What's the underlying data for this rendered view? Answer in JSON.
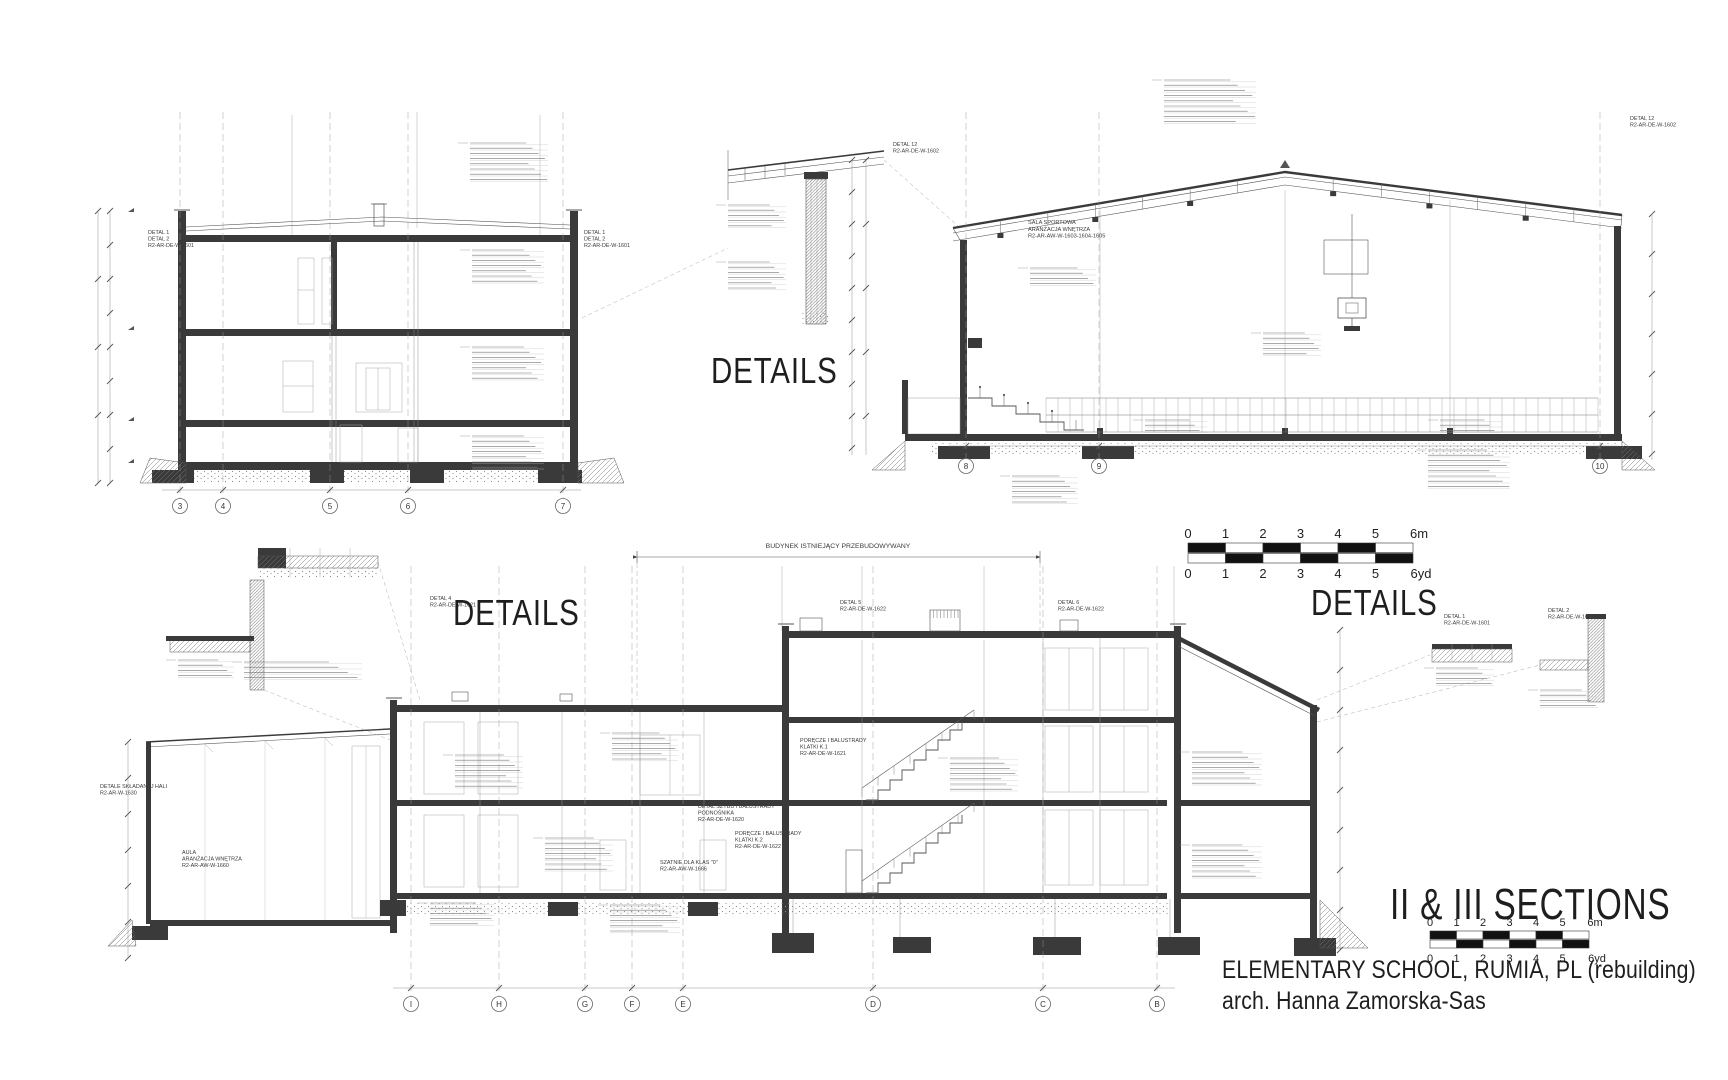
{
  "titles": {
    "details": "DETAILS",
    "sections": "II & III SECTIONS",
    "project": "ELEMENTARY SCHOOL, RUMIA, PL (rebuilding)",
    "architect": "arch. Hanna Zamorska-Sas"
  },
  "scalebar_units": {
    "m": [
      "0",
      "1",
      "2",
      "3",
      "4",
      "5",
      "6m"
    ],
    "yd": [
      "0",
      "1",
      "2",
      "3",
      "4",
      "5",
      "6yd"
    ]
  },
  "drawing": {
    "grids": [
      {
        "name": "upper-left-section",
        "top": 112,
        "dim_y": 490,
        "bubble_y": 506,
        "items": [
          {
            "label": "3",
            "x": 180
          },
          {
            "label": "4",
            "x": 223
          },
          {
            "label": "5",
            "x": 330
          },
          {
            "label": "6",
            "x": 408
          },
          {
            "label": "7",
            "x": 563
          }
        ]
      },
      {
        "name": "sports-hall",
        "top": 112,
        "dim_y": 446,
        "bubble_y": 466,
        "items": [
          {
            "label": "8",
            "x": 966
          },
          {
            "label": "9",
            "x": 1099
          },
          {
            "label": "10",
            "x": 1600
          }
        ]
      },
      {
        "name": "lower-section",
        "top": 566,
        "dim_y": 988,
        "bubble_y": 1004,
        "items": [
          {
            "label": "I",
            "x": 411
          },
          {
            "label": "H",
            "x": 499
          },
          {
            "label": "G",
            "x": 585
          },
          {
            "label": "F",
            "x": 632
          },
          {
            "label": "E",
            "x": 683
          },
          {
            "label": "D",
            "x": 873
          },
          {
            "label": "C",
            "x": 1043
          },
          {
            "label": "B",
            "x": 1157
          }
        ]
      }
    ],
    "scalebars": [
      {
        "x": 1188,
        "y": 543,
        "unit": 37.5,
        "h": 9.5,
        "label_size": 13,
        "m_label_y": 538,
        "yd_label_y": 578
      },
      {
        "x": 1430,
        "y": 931,
        "unit": 26.5,
        "h": 8,
        "label_size": 11,
        "m_label_y": 926,
        "yd_label_y": 962
      }
    ],
    "note_blocks": [
      {
        "x": 470,
        "y": 143,
        "w": 78,
        "n": 8
      },
      {
        "x": 472,
        "y": 250,
        "w": 72,
        "n": 7
      },
      {
        "x": 472,
        "y": 347,
        "w": 72,
        "n": 7
      },
      {
        "x": 472,
        "y": 436,
        "w": 72,
        "n": 7
      },
      {
        "x": 1164,
        "y": 80,
        "w": 92,
        "n": 9
      },
      {
        "x": 728,
        "y": 205,
        "w": 58,
        "n": 5
      },
      {
        "x": 728,
        "y": 262,
        "w": 58,
        "n": 6
      },
      {
        "x": 1030,
        "y": 268,
        "w": 66,
        "n": 4
      },
      {
        "x": 1263,
        "y": 333,
        "w": 58,
        "n": 5
      },
      {
        "x": 1428,
        "y": 450,
        "w": 82,
        "n": 8
      },
      {
        "x": 1012,
        "y": 476,
        "w": 66,
        "n": 6
      },
      {
        "x": 1145,
        "y": 420,
        "w": 62,
        "n": 3
      },
      {
        "x": 1440,
        "y": 420,
        "w": 62,
        "n": 3
      },
      {
        "x": 455,
        "y": 755,
        "w": 68,
        "n": 7
      },
      {
        "x": 545,
        "y": 838,
        "w": 68,
        "n": 7
      },
      {
        "x": 612,
        "y": 733,
        "w": 66,
        "n": 6
      },
      {
        "x": 950,
        "y": 758,
        "w": 68,
        "n": 7
      },
      {
        "x": 1192,
        "y": 752,
        "w": 70,
        "n": 7
      },
      {
        "x": 1192,
        "y": 845,
        "w": 70,
        "n": 7
      },
      {
        "x": 610,
        "y": 905,
        "w": 70,
        "n": 6
      },
      {
        "x": 244,
        "y": 662,
        "w": 118,
        "n": 4
      },
      {
        "x": 1436,
        "y": 668,
        "w": 58,
        "n": 4
      },
      {
        "x": 1540,
        "y": 690,
        "w": 58,
        "n": 4
      },
      {
        "x": 178,
        "y": 660,
        "w": 56,
        "n": 4
      },
      {
        "x": 430,
        "y": 903,
        "w": 64,
        "n": 5
      }
    ],
    "callouts": [
      {
        "x": 148,
        "y": 234,
        "lines": [
          "DETAL 1",
          "DETAL 2",
          "R2-AR-DE-W-1601"
        ]
      },
      {
        "x": 584,
        "y": 234,
        "lines": [
          "DETAL 1",
          "DETAL 2",
          "R2-AR-DE-W-1601"
        ]
      },
      {
        "x": 893,
        "y": 146,
        "lines": [
          "DETAL 12",
          "R2-AR-DE-W-1602"
        ]
      },
      {
        "x": 1630,
        "y": 120,
        "lines": [
          "DETAL 12",
          "R2-AR-DE-W-1602"
        ]
      },
      {
        "x": 1028,
        "y": 224,
        "size": 5.6,
        "lines": [
          "SALA SPORTOWA",
          "ARANŻACJA WNĘTRZA",
          "R2-AR-AW-W-1603-1604-1605"
        ]
      },
      {
        "x": 840,
        "y": 604,
        "lines": [
          "DETAL 5",
          "R2-AR-DE-W-1622"
        ]
      },
      {
        "x": 1058,
        "y": 604,
        "lines": [
          "DETAL 6",
          "R2-AR-DE-W-1622"
        ]
      },
      {
        "x": 430,
        "y": 600,
        "lines": [
          "DETAL 4",
          "R2-AR-DE-W-1621"
        ]
      },
      {
        "x": 1444,
        "y": 618,
        "lines": [
          "DETAL 1",
          "R2-AR-DE-W-1601"
        ]
      },
      {
        "x": 1548,
        "y": 612,
        "lines": [
          "DETAL 2",
          "R2-AR-DE-W-1601"
        ]
      },
      {
        "x": 182,
        "y": 854,
        "lines": [
          "AULA",
          "ARANŻACJA WNĘTRZA",
          "R2-AR-AW-W-1660"
        ]
      },
      {
        "x": 100,
        "y": 788,
        "lines": [
          "DETALE SKŁADANEJ HALI",
          "R2-AR-W-1630"
        ]
      },
      {
        "x": 800,
        "y": 742,
        "lines": [
          "PORĘCZE I BALUSTRADY",
          "KLATKI K.1",
          "R2-AR-DE-W-1621"
        ]
      },
      {
        "x": 735,
        "y": 835,
        "lines": [
          "PORĘCZE I BALUSTRADY",
          "KLATKI K.2",
          "R2-AR-DE-W-1622"
        ]
      },
      {
        "x": 698,
        "y": 808,
        "lines": [
          "DETAL SZYBU I BALUSTRADY",
          "PODNOŚNIKA",
          "R2-AR-DE-W-1620"
        ]
      },
      {
        "x": 660,
        "y": 864,
        "lines": [
          "SZATNIE DLA KLAS \"0\"",
          "R2-AR-AW-W-1666"
        ]
      },
      {
        "x": 838,
        "y": 548,
        "size": 6.8,
        "anchor": "middle",
        "lines": [
          "BUDYNEK ISTNIEJĄCY PRZEBUDOWYWANY"
        ]
      }
    ]
  },
  "colors": {
    "ink": "#3a3a3a",
    "line": "#555555",
    "light_line": "#9a9a9a",
    "text": "#1e1e1e"
  }
}
